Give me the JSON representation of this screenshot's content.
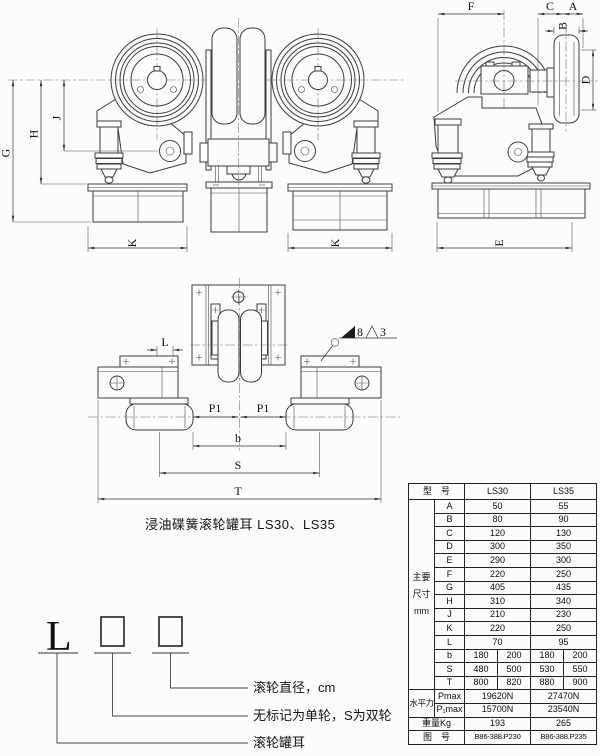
{
  "caption": "浸油碟簧滚轮罐耳 LS30、LS35",
  "top_drawing": {
    "dims": {
      "G": "G",
      "H": "H",
      "J": "J",
      "K_left": "K",
      "K_mid": "K",
      "F": "F",
      "C": "C",
      "A": "A",
      "B": "B",
      "D": "D",
      "E": "E"
    }
  },
  "plan_drawing": {
    "dims": {
      "L": "L",
      "P1_left": "P1",
      "P1_right": "P1",
      "b": "b",
      "S": "S",
      "T": "T"
    },
    "weld": {
      "size": "8",
      "finish": "3"
    }
  },
  "designation": {
    "prefix": "L",
    "leaders": [
      {
        "label": "滚轮直径，cm"
      },
      {
        "label": "无标记为单轮，S为双轮"
      },
      {
        "label": "滚轮罐耳"
      }
    ]
  },
  "spec_table": {
    "model_header": "型　号",
    "models": [
      "LS30",
      "LS35"
    ],
    "dims_group": "主要尺寸mm",
    "dim_rows": [
      {
        "label": "A",
        "v30": "50",
        "v35": "55"
      },
      {
        "label": "B",
        "v30": "80",
        "v35": "90"
      },
      {
        "label": "C",
        "v30": "120",
        "v35": "130"
      },
      {
        "label": "D",
        "v30": "300",
        "v35": "350"
      },
      {
        "label": "E",
        "v30": "290",
        "v35": "300"
      },
      {
        "label": "F",
        "v30": "220",
        "v35": "250"
      },
      {
        "label": "G",
        "v30": "405",
        "v35": "435"
      },
      {
        "label": "H",
        "v30": "310",
        "v35": "340"
      },
      {
        "label": "J",
        "v30": "210",
        "v35": "230"
      },
      {
        "label": "K",
        "v30": "220",
        "v35": "250"
      },
      {
        "label": "L",
        "v30": "70",
        "v35": "95"
      }
    ],
    "split_rows": [
      {
        "label": "b",
        "v30a": "180",
        "v30b": "200",
        "v35a": "180",
        "v35b": "200"
      },
      {
        "label": "S",
        "v30a": "480",
        "v30b": "500",
        "v35a": "530",
        "v35b": "550"
      },
      {
        "label": "T",
        "v30a": "800",
        "v30b": "820",
        "v35a": "880",
        "v35b": "900"
      }
    ],
    "force_group": "水平力",
    "force_rows": [
      {
        "label": "Pmax",
        "v30": "19620N",
        "v35": "27470N"
      },
      {
        "label": "P₁max",
        "v30": "15700N",
        "v35": "23540N"
      }
    ],
    "weight_row": {
      "label": "重量Kg",
      "v30": "193",
      "v35": "265"
    },
    "drawing_no_row": {
      "label": "图　号",
      "v30": "B86-388.P230",
      "v35": "B86-388.P235"
    }
  }
}
